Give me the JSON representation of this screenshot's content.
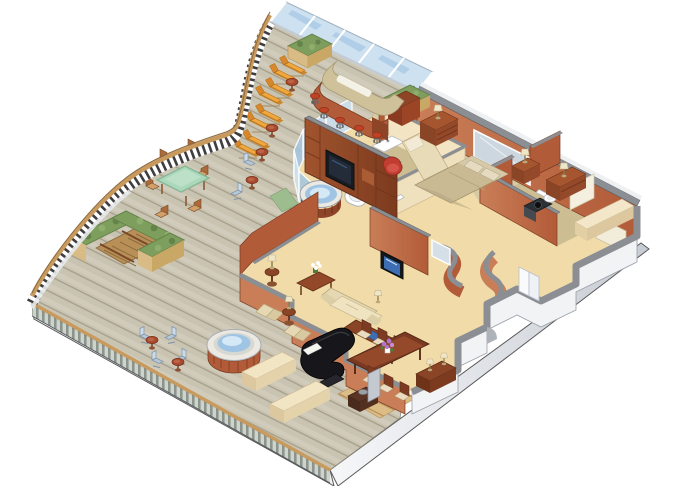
{
  "scene": {
    "type": "isometric-cutaway-floorplan",
    "subject": "cruise-ship-suite-with-wraparound-sun-deck",
    "rooms": [
      {
        "name": "sun-deck",
        "furniture": [
          "windscreen-glass-panels",
          "curved-bow-railing",
          "deck-balustrade",
          "bar-counter",
          "bar-stools",
          "hedge-planters",
          "lounge-chair-pairs",
          "round-drink-tables",
          "glass-top-dining-table",
          "outdoor-dining-chairs",
          "stair-enclosure-with-hedges",
          "staircase",
          "open-deck-hot-tub",
          "folding-deck-chairs",
          "bench-seats"
        ]
      },
      {
        "name": "bedroom",
        "furniture": [
          "double-bed",
          "pillows",
          "wall-mirror",
          "dresser-with-lamp",
          "nightstand-with-lamp",
          "second-dresser-with-lamp",
          "daybed",
          "red-armchair",
          "closet-door"
        ]
      },
      {
        "name": "master-bathroom",
        "furniture": [
          "glass-enclosed-hot-tub",
          "bathtub",
          "shower-stall",
          "toilet",
          "sink-counter",
          "green-mat"
        ]
      },
      {
        "name": "second-bathroom",
        "furniture": [
          "toilet",
          "dark-vanity-sink",
          "closet-panel",
          "corner-bench"
        ]
      },
      {
        "name": "living-room",
        "furniture": [
          "tv-wall-unit",
          "television",
          "sofa",
          "armchairs",
          "coffee-table-with-white-flowers",
          "pedestal-lamp-tables",
          "writing-desk",
          "grand-piano",
          "piano-bench"
        ]
      },
      {
        "name": "dining-room",
        "furniture": [
          "dining-table",
          "dining-chairs",
          "purple-flower-centerpiece",
          "sideboard-with-lamps",
          "wall-television"
        ]
      },
      {
        "name": "entry",
        "furniture": [
          "entry-doors",
          "console-table",
          "decorative-bowl",
          "leaning-mirror-panel",
          "wood-floor"
        ]
      }
    ]
  },
  "palette": {
    "deck": "#c9c3b1",
    "deck-line": "#a29a86",
    "deck-light": "#dad5c5",
    "hull": "#f3f4f6",
    "hull-shade": "#c7ccd3",
    "outline": "#4e4e4e",
    "rail-wood": "#c89a5e",
    "baluster": "#3e3e40",
    "glass": "#cde1f0",
    "glass-sky": "#a4c6e2",
    "wall": "#b25b39",
    "wall-light": "#c97e57",
    "wall-dark": "#8e4527",
    "wall-top": "#8b8f94",
    "cream-wall": "#f3e4c3",
    "floor": "#f1dca9",
    "floor-bed": "#d7caa5",
    "floor-bath": "#ccbd92",
    "floor-wood": "#ddbd86",
    "wood": "#9a4e2a",
    "wood-dark": "#713420",
    "uphol": "#e8dcb8",
    "uphol-dark": "#d5c49c",
    "lounger": "#f0a73e",
    "lounger-dark": "#d8882b",
    "stool": "#bf4126",
    "hedge": "#7d9e5d",
    "hedge-dark": "#64834a",
    "planter": "#d9bb85",
    "water": "#9fc4e4",
    "water-hi": "#d5e8f6",
    "rim": "#ebe9e2",
    "piano": "#17171b",
    "tv": "#3d6db3",
    "glass-table": "#abd7ba",
    "chair-blue": "#b7c9d9",
    "flower-purple": "#ae76c6",
    "leaf-green": "#4e7c3c",
    "bed": "#c9ba94",
    "pillow": "#e6dac0",
    "red-chair": "#c23c31",
    "white-fixture": "#ffffff"
  }
}
